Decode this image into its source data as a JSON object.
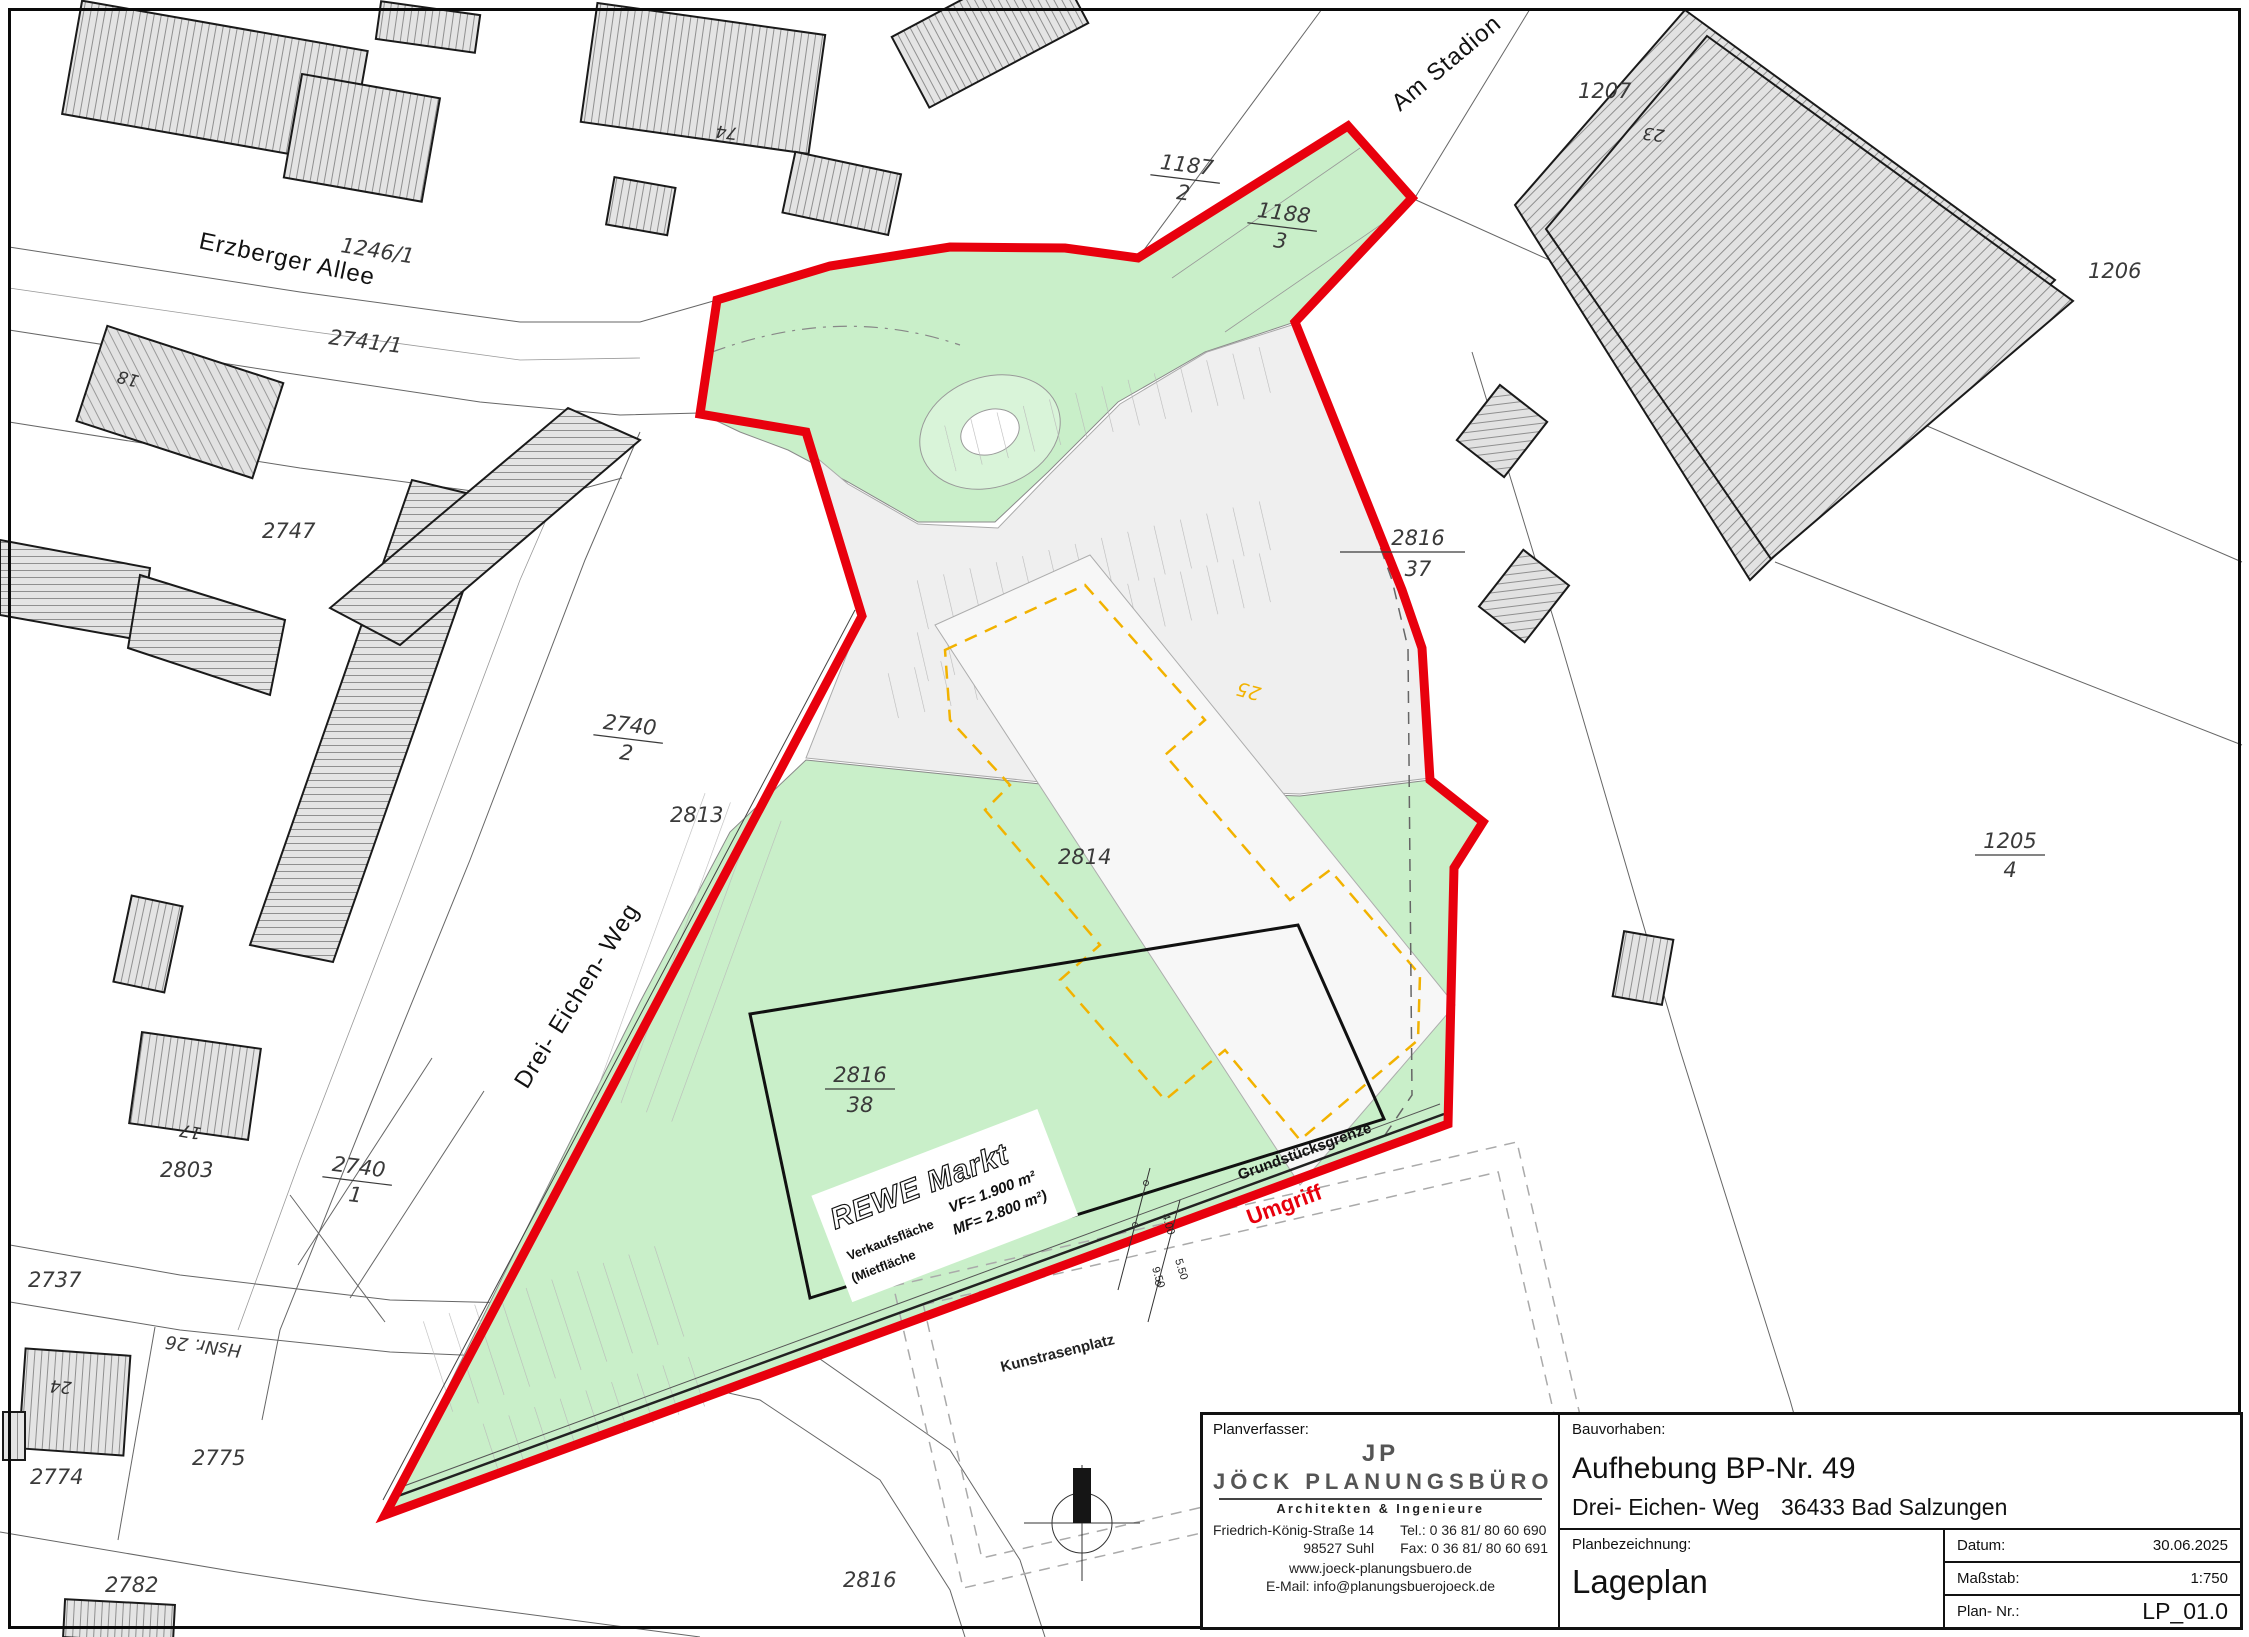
{
  "colors": {
    "umgriff_red": "#e8000d",
    "site_green": "#c9efc9",
    "parking_gray": "#efefef",
    "band_white": "#f7f7f7",
    "old_outline_orange": "#f2b200",
    "building_hatch_gray": "#e4e4e4"
  },
  "streets": {
    "erzberger_allee": "Erzberger Allee",
    "am_stadion": "Am Stadion",
    "drei_eichen_weg": "Drei- Eichen- Weg"
  },
  "parcels": {
    "p1246_1": "1246/1",
    "p2741_1": "2741/1",
    "p2747": "2747",
    "p2813": "2813",
    "p2814": "2814",
    "p2737": "2737",
    "p2774": "2774",
    "p2775": "2775",
    "p2782": "2782",
    "p2803": "2803",
    "p2816": "2816",
    "p1207": "1207",
    "p1206": "1206",
    "hsnr26": "HsNr. 26"
  },
  "fractions": {
    "p1187_2": {
      "num": "1187",
      "den": "2"
    },
    "p1188_3": {
      "num": "1188",
      "den": "3"
    },
    "p2816_37": {
      "num": "2816",
      "den": "37"
    },
    "p2816_38": {
      "num": "2816",
      "den": "38"
    },
    "p1205_4": {
      "num": "1205",
      "den": "4"
    },
    "p2740_2": {
      "num": "2740",
      "den": "2"
    },
    "p2740_1": {
      "num": "2740",
      "den": "1"
    }
  },
  "house_numbers": {
    "h74": "74",
    "h18": "18",
    "h23": "23",
    "h17": "17",
    "h24": "24",
    "h25": "25"
  },
  "site": {
    "umgriff": "Umgriff",
    "grundstuecksgrenze": "Grundstücksgrenze",
    "kunstrasenplatz": "Kunstrasenplatz",
    "rewe_title": "REWE Markt",
    "rewe_left1": "Verkaufsfläche",
    "rewe_left2": "(Mietfläche",
    "rewe_right1": "VF= 1.900 m²",
    "rewe_right2": "MF= 2.800 m²)",
    "dim1": "4.00",
    "dim2": "5.50",
    "dim3": "9.50"
  },
  "title_block": {
    "planverfasser_label": "Planverfasser:",
    "logo_initials": "JP",
    "company": "JÖCK PLANUNGSBÜRO",
    "company_sub": "Architekten & Ingenieure",
    "address_line1": "Friedrich-König-Straße 14",
    "address_line2": "98527 Suhl",
    "tel": "Tel.:  0 36 81/ 80 60 690",
    "fax": "Fax:  0 36 81/ 80 60 691",
    "web": "www.joeck-planungsbuero.de",
    "email": "E-Mail:  info@planungsbuerojoeck.de",
    "bauvorhaben_label": "Bauvorhaben:",
    "project_title": "Aufhebung BP-Nr. 49",
    "project_street": "Drei- Eichen- Weg",
    "project_city": "36433 Bad Salzungen",
    "planbezeichnung_label": "Planbezeichnung:",
    "plan_name": "Lageplan",
    "datum_label": "Datum:",
    "datum_value": "30.06.2025",
    "massstab_label": "Maßstab:",
    "massstab_value": "1:750",
    "plannr_label": "Plan- Nr.:",
    "plannr_value": "LP_01.0"
  }
}
